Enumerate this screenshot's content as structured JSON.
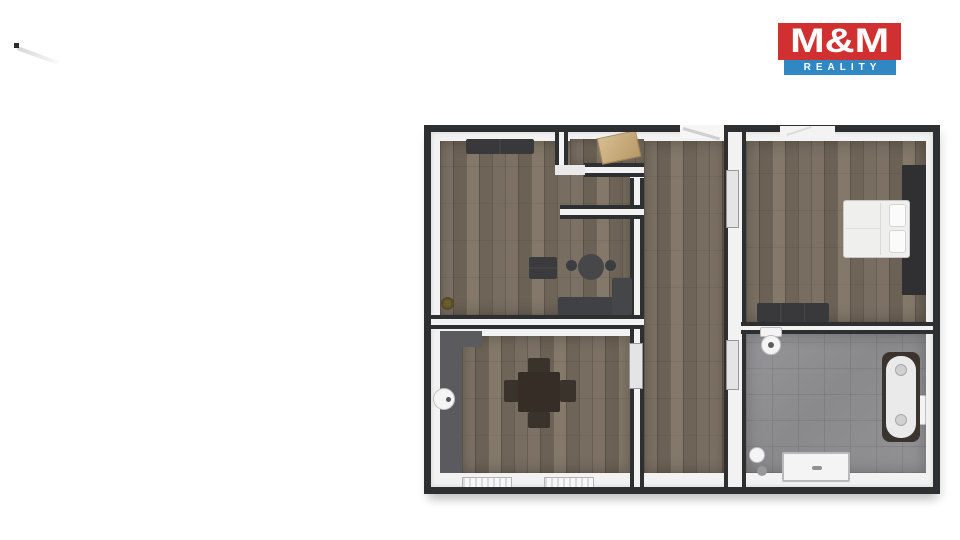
{
  "logo": {
    "title": "M&M",
    "subtitle": "REALITY"
  },
  "colors": {
    "brand_red": "#d13030",
    "brand_blue": "#2f87c3",
    "wall_dark": "#2e2f31",
    "wall_light": "#f2f2f2",
    "floor_wood": "#74695c",
    "floor_tile": "#8f8f90",
    "furniture_dark": "#3a3a3c",
    "door_tan": "#cdb383",
    "counter_gray": "#5a5a5f"
  }
}
